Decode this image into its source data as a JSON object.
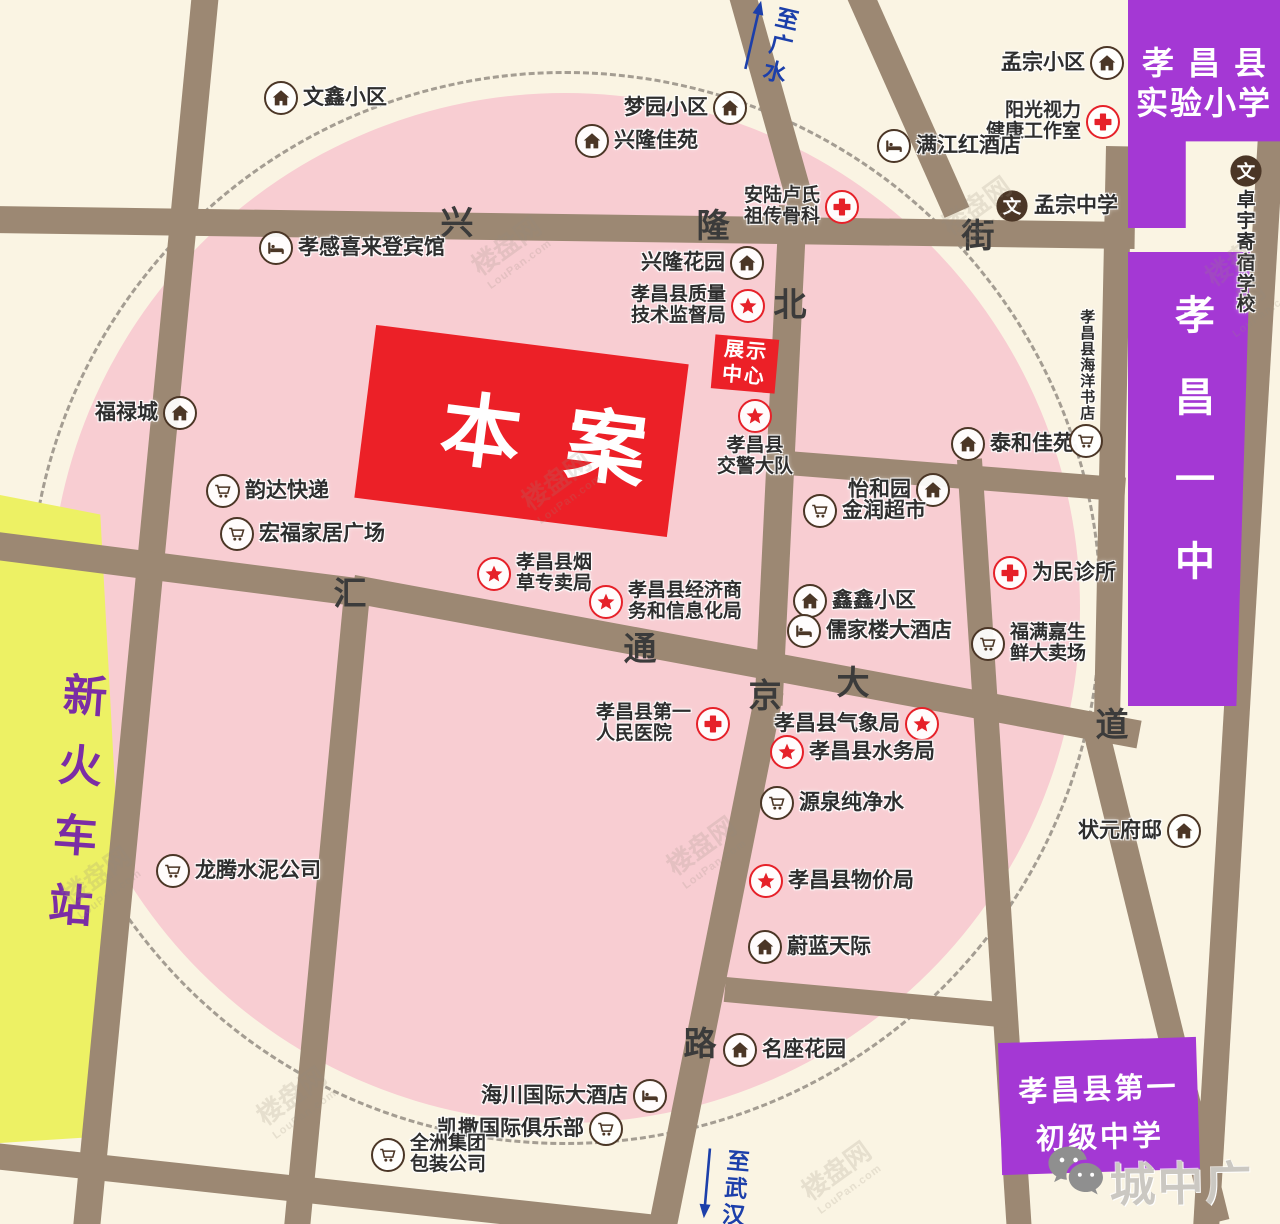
{
  "colors": {
    "background": "#faf4e3",
    "pink_zone": "#f8cdd2",
    "road": "#9c8873",
    "project_red": "#ec2027",
    "school_purple": "#a438d4",
    "station_yellow": "#edf164",
    "direction_blue": "#1c3faa",
    "icon_brown": "#4b3626",
    "icon_red": "#e62129",
    "station_text_purple": "#7b2da5"
  },
  "project": {
    "label": "本案"
  },
  "exhibition_center": {
    "line1": "展示",
    "line2": "中心"
  },
  "blocks": {
    "new_railway_station": {
      "label": "新火车站"
    },
    "experimental_primary_school": {
      "line1": "孝昌县",
      "line2": "实验小学"
    },
    "xiaochang_no1_high_school": {
      "label": "孝昌一中"
    },
    "no1_junior_middle_school": {
      "line1": "孝昌县第一",
      "line2": "初级中学"
    }
  },
  "roads": [
    {
      "name": "xinglong-street",
      "chars": [
        {
          "c": "兴",
          "x": 457,
          "y": 220
        },
        {
          "c": "隆",
          "x": 713,
          "y": 223
        },
        {
          "c": "街",
          "x": 978,
          "y": 233
        }
      ]
    },
    {
      "name": "beijing-road",
      "chars": [
        {
          "c": "北",
          "x": 790,
          "y": 302
        },
        {
          "c": "京",
          "x": 765,
          "y": 693
        },
        {
          "c": "路",
          "x": 700,
          "y": 1041
        }
      ]
    },
    {
      "name": "huitong-avenue",
      "chars": [
        {
          "c": "汇",
          "x": 350,
          "y": 591
        },
        {
          "c": "通",
          "x": 640,
          "y": 646
        },
        {
          "c": "大",
          "x": 853,
          "y": 680
        },
        {
          "c": "道",
          "x": 1112,
          "y": 722
        }
      ]
    }
  ],
  "directions": [
    {
      "name": "to-guangshui",
      "label": "至广水",
      "dir": "up",
      "x": 745,
      "y": 4,
      "rot": 13
    },
    {
      "name": "to-wuhan",
      "label": "至武汉",
      "dir": "down",
      "x": 700,
      "y": 1148,
      "rot": 5
    }
  ],
  "pois": [
    {
      "name": "wenxin-community",
      "icon": "house",
      "x": 281,
      "y": 98,
      "side": "right",
      "label": "文鑫小区"
    },
    {
      "name": "mengyuan-community",
      "icon": "house",
      "x": 728,
      "y": 108,
      "side": "left",
      "label": "梦园小区"
    },
    {
      "name": "xinglong-jiayuan",
      "icon": "house",
      "x": 592,
      "y": 141,
      "side": "right",
      "label": "兴隆佳苑"
    },
    {
      "name": "mengzong-community",
      "icon": "house",
      "x": 1105,
      "y": 63,
      "side": "left",
      "label": "孟宗小区"
    },
    {
      "name": "yangguang-vision-studio",
      "icon": "cross",
      "x": 1101,
      "y": 118,
      "side": "left",
      "label": "阳光视力\n健康工作室",
      "align": "right"
    },
    {
      "name": "manjianghong-hotel",
      "icon": "bed",
      "x": 894,
      "y": 146,
      "side": "right",
      "label": "满江红酒店"
    },
    {
      "name": "anlu-lushi-bonesetting",
      "icon": "cross",
      "x": 840,
      "y": 203,
      "side": "left",
      "label": "安陆卢氏\n祖传骨科",
      "align": "left"
    },
    {
      "name": "mengzong-middle-school",
      "icon": "wen",
      "x": 1012,
      "y": 206,
      "side": "right",
      "label": "孟宗中学"
    },
    {
      "name": "xiaogan-xilaideng-hotel",
      "icon": "bed",
      "x": 276,
      "y": 248,
      "side": "right",
      "label": "孝感喜来登宾馆"
    },
    {
      "name": "xinglong-garden",
      "icon": "house",
      "x": 745,
      "y": 263,
      "side": "left",
      "label": "兴隆花园"
    },
    {
      "name": "quality-supervision-bureau",
      "icon": "star",
      "x": 746,
      "y": 302,
      "side": "left",
      "label": "孝昌县质量\n技术监督局",
      "align": "left"
    },
    {
      "name": "fulucheng",
      "icon": "house",
      "x": 178,
      "y": 413,
      "side": "left",
      "label": "福禄城"
    },
    {
      "name": "traffic-police-brigade",
      "icon": "star",
      "x": 755,
      "y": 416,
      "side": "bottom",
      "label": "孝昌县\n交警大队"
    },
    {
      "name": "taihe-jiayuan",
      "icon": "house",
      "x": 968,
      "y": 444,
      "side": "right",
      "label": "泰和佳苑"
    },
    {
      "name": "haiyang-bookstore",
      "icon": "cart",
      "x": 1086,
      "y": 445,
      "side": "top",
      "label": "孝昌县海洋书店",
      "vertical": true
    },
    {
      "name": "yihe-garden",
      "icon": "house",
      "x": 931,
      "y": 490,
      "side": "left",
      "label": "怡和园"
    },
    {
      "name": "yunda-express",
      "icon": "cart",
      "x": 223,
      "y": 491,
      "side": "right",
      "label": "韵达快递"
    },
    {
      "name": "jinrun-supermarket",
      "icon": "cart",
      "x": 820,
      "y": 511,
      "side": "right",
      "label": "金润超市"
    },
    {
      "name": "hongfu-home-plaza",
      "icon": "cart",
      "x": 237,
      "y": 534,
      "side": "right",
      "label": "宏福家居广场"
    },
    {
      "name": "tobacco-monopoly-bureau",
      "icon": "star",
      "x": 494,
      "y": 570,
      "side": "right",
      "label": "孝昌县烟\n草专卖局"
    },
    {
      "name": "weimin-clinic",
      "icon": "cross",
      "x": 1010,
      "y": 573,
      "side": "right",
      "label": "为民诊所"
    },
    {
      "name": "economy-information-bureau",
      "icon": "star",
      "x": 606,
      "y": 598,
      "side": "right",
      "label": "孝昌县经济商\n务和信息化局"
    },
    {
      "name": "xinxin-community",
      "icon": "house",
      "x": 810,
      "y": 601,
      "side": "right",
      "label": "鑫鑫小区"
    },
    {
      "name": "rujialou-hotel",
      "icon": "bed",
      "x": 804,
      "y": 631,
      "side": "right",
      "label": "儒家楼大酒店"
    },
    {
      "name": "fumanjia-fresh-market",
      "icon": "cart",
      "x": 988,
      "y": 640,
      "side": "right",
      "label": "福满嘉生\n鲜大卖场"
    },
    {
      "name": "no1-peoples-hospital",
      "icon": "cross",
      "x": 711,
      "y": 720,
      "side": "left",
      "label": "孝昌县第一\n人民医院",
      "align": "left"
    },
    {
      "name": "meteorological-bureau",
      "icon": "star",
      "x": 920,
      "y": 724,
      "side": "left",
      "label": "孝昌县气象局"
    },
    {
      "name": "water-affairs-bureau",
      "icon": "star",
      "x": 787,
      "y": 752,
      "side": "right",
      "label": "孝昌县水务局"
    },
    {
      "name": "yuanquan-pure-water",
      "icon": "cart",
      "x": 777,
      "y": 803,
      "side": "right",
      "label": "源泉纯净水"
    },
    {
      "name": "zhuangyuan-mansion",
      "icon": "house",
      "x": 1182,
      "y": 831,
      "side": "left",
      "label": "状元府邸"
    },
    {
      "name": "longteng-cement",
      "icon": "cart",
      "x": 173,
      "y": 871,
      "side": "right",
      "label": "龙腾水泥公司"
    },
    {
      "name": "price-bureau",
      "icon": "star",
      "x": 766,
      "y": 881,
      "side": "right",
      "label": "孝昌县物价局"
    },
    {
      "name": "weilan-tianji",
      "icon": "house",
      "x": 765,
      "y": 947,
      "side": "right",
      "label": "蔚蓝天际"
    },
    {
      "name": "mingzuo-garden",
      "icon": "house",
      "x": 740,
      "y": 1050,
      "side": "right",
      "label": "名座花园"
    },
    {
      "name": "haichuan-intl-hotel",
      "icon": "bed",
      "x": 648,
      "y": 1096,
      "side": "left",
      "label": "海川国际大酒店"
    },
    {
      "name": "kaisa-intl-club",
      "icon": "cart",
      "x": 604,
      "y": 1129,
      "side": "left",
      "label": "凯撒国际俱乐部"
    },
    {
      "name": "quanzhou-packaging",
      "icon": "cart",
      "x": 388,
      "y": 1151,
      "side": "right",
      "label": "全洲集团\n包装公司"
    },
    {
      "name": "zhuoyu-boarding-school",
      "icon": "wen",
      "x": 1246,
      "y": 171,
      "side": "bottom",
      "label": "卓宇\n寄宿学校"
    }
  ],
  "footer": {
    "brand": "城中广场"
  },
  "watermark": {
    "text": "楼盘网",
    "sub": "LouPan.com",
    "positions": [
      {
        "x": 470,
        "y": 225
      },
      {
        "x": 1205,
        "y": 240
      },
      {
        "x": 60,
        "y": 855
      },
      {
        "x": 665,
        "y": 825
      },
      {
        "x": 255,
        "y": 1075
      },
      {
        "x": 800,
        "y": 1150
      },
      {
        "x": 520,
        "y": 460
      },
      {
        "x": 940,
        "y": 185
      }
    ]
  }
}
